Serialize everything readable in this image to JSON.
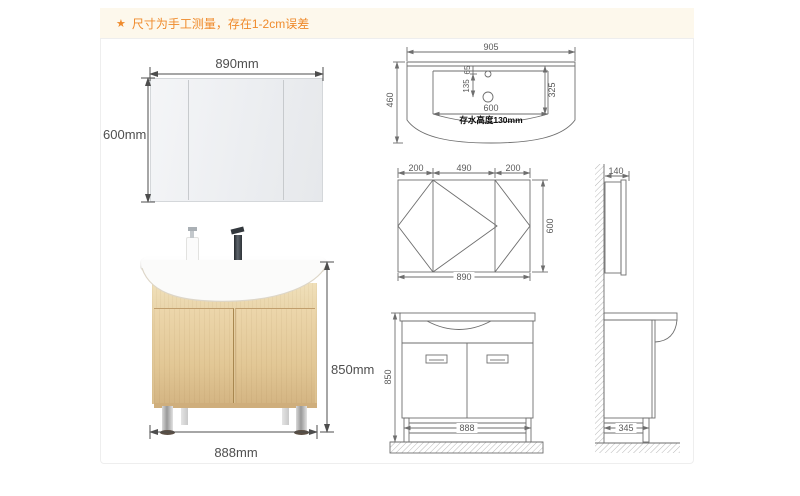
{
  "note": {
    "star": "★",
    "text": "尺寸为手工测量，存在1-2cm误差"
  },
  "mirror_diagram": {
    "width": "890mm",
    "height": "600mm"
  },
  "cabinet_photo": {
    "height": "850mm",
    "width": "888mm"
  },
  "basin_top_view": {
    "overall_width": "905",
    "overall_depth": "460",
    "faucet_hole_offset": "65",
    "drain_offset": "135",
    "inner_width": "600",
    "inner_depth": "325",
    "water_note": "存水高度130mm"
  },
  "mirror_cabinet_front_view": {
    "left_width": "200",
    "center_width": "490",
    "right_width": "200",
    "height": "600",
    "total_width": "890"
  },
  "cabinet_front_view": {
    "height": "850",
    "width": "888"
  },
  "cabinet_side_view": {
    "mirror_cabinet_depth": "140",
    "cabinet_depth": "345"
  },
  "colors": {
    "accent_orange": "#ef8a2b",
    "note_bg": "#fdf8ec",
    "drawing_line": "#6b6b6b",
    "wood": "#e2c79c"
  }
}
